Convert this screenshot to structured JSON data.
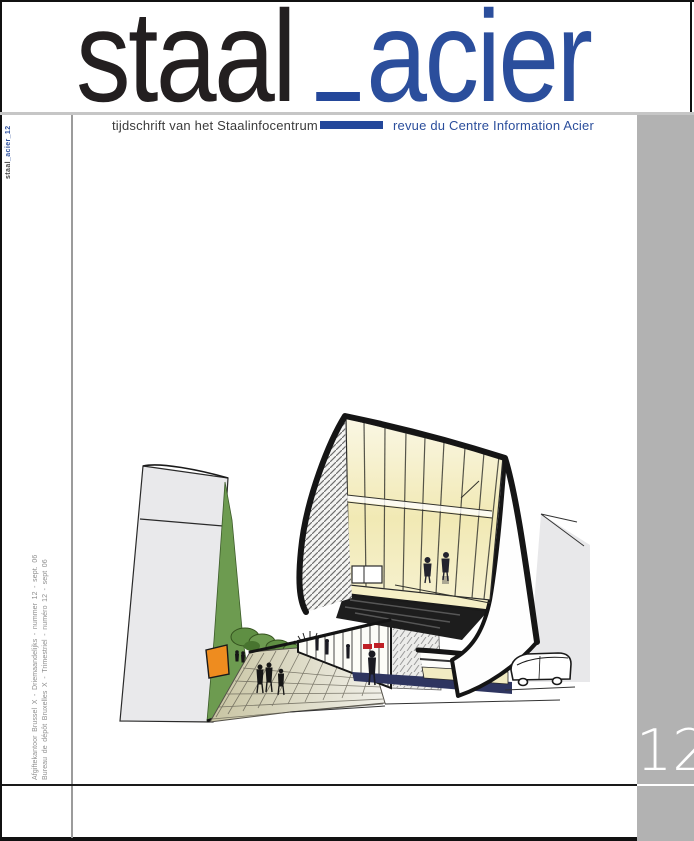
{
  "masthead": {
    "word_black": "staal",
    "word_blue": "acier"
  },
  "taglines": {
    "dutch": "tijdschrift van het Staalinfocentrum",
    "french": "revue du Centre Information Acier"
  },
  "spine": {
    "top_black": "staal",
    "top_blue": "_acier_12",
    "bottom_line1": "Afgiftekantoor Brussel X - Driemaandelijks - nummer 12 - sept. 06",
    "bottom_line2": "Bureau de dépôt Bruxelles X - Trimestriel - numéro 12 - sept 06"
  },
  "issue": {
    "number": "12"
  },
  "colors": {
    "brand_blue": "#2b4e9c",
    "bar_blue": "#24479a",
    "band_gray": "#b2b2b2",
    "title_black": "#231f20"
  }
}
